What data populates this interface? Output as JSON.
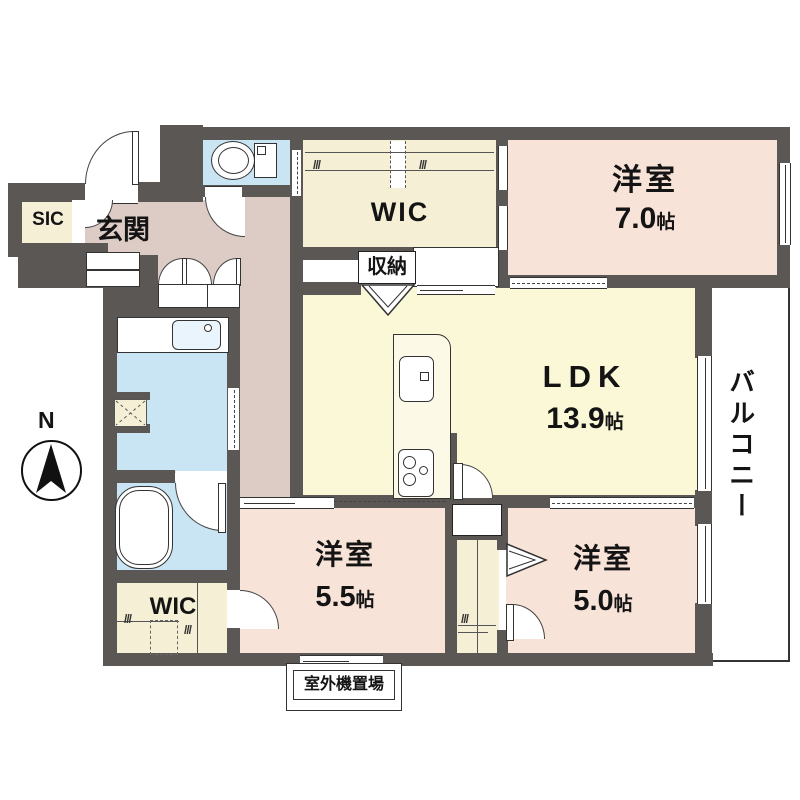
{
  "plan": {
    "compass_label": "N",
    "glyphs": {
      "hanger": "///"
    },
    "rooms": {
      "sic": "SIC",
      "entrance": "玄関",
      "wic_top": "WIC",
      "storage_top": "収納",
      "bedroom_top": {
        "name": "洋室",
        "area": "7.0",
        "unit": "帖"
      },
      "ldk": {
        "name": "LDK",
        "area": "13.9",
        "unit": "帖"
      },
      "bedroom_mid": {
        "name": "洋室",
        "area": "5.5",
        "unit": "帖"
      },
      "bedroom_right": {
        "name": "洋室",
        "area": "5.0",
        "unit": "帖"
      },
      "wic_bottom": "WIC",
      "storage_bottom": "収納",
      "balcony": "バルコニー",
      "outdoor_unit": "室外機置場"
    },
    "colors": {
      "wall": "#5a5755",
      "room_pink": "#f8e3d8",
      "entrance_pink": "#ddccc6",
      "ldk_yellow": "#fbf8d8",
      "closet_cream": "#f5f0d5",
      "water_blue": "#c9e5f4"
    }
  }
}
